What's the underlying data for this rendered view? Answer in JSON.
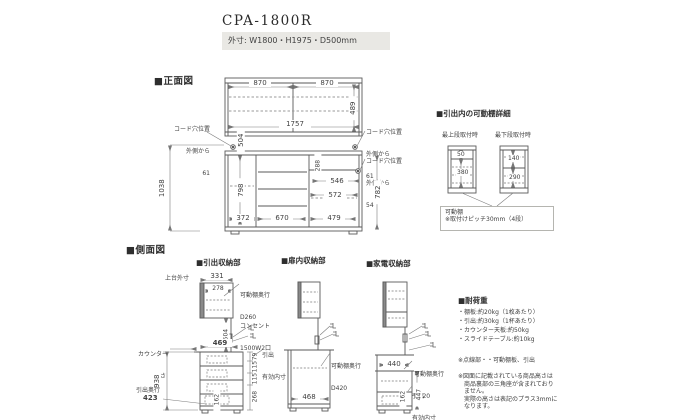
{
  "header": {
    "model": "CPA-1800R",
    "outer_dims": "外寸: W1800・H1975・D500mm"
  },
  "colors": {
    "subtitle_box_bg": "#e9e8e4",
    "line": "#5a5a5a",
    "dashed": "#9a9a9a"
  },
  "front": {
    "label": "■正面図",
    "d870a": "870",
    "d870b": "870",
    "d489": "489",
    "d1757": "1757",
    "d504": "504",
    "cord_left": {
      "l1": "コード穴位置",
      "l2": "外側から",
      "v": "61"
    },
    "cord_rt": {
      "l1": "コード穴位置",
      "l2": "外側から",
      "v": "61"
    },
    "cord_rb": {
      "l1": "コード穴位置",
      "l2": "外側から",
      "v": "54"
    },
    "d1038": "1038",
    "d798": "798",
    "d288": "288",
    "d546": "546",
    "d572": "572",
    "d782": "782",
    "d372": "372",
    "d670": "670",
    "d479": "479"
  },
  "detail": {
    "title": "■引出内の可動棚詳細",
    "cap_top": "最上段取付時",
    "cap_bottom": "最下段取付時",
    "v50": "50",
    "v380": "380",
    "v140": "140",
    "v290": "290",
    "note1": "可動棚",
    "note2": "※取付けピッチ30mm（4段）"
  },
  "side": {
    "label": "■側面図",
    "du": {
      "title": "■引出収納部",
      "upper_label": "上台外寸",
      "d331": "331",
      "d278": "278",
      "shelf1": "可動棚奥行",
      "shelf2": "D260",
      "d504": "504",
      "outlet1": "コンセント",
      "outlet2": "1500W2口",
      "counter1": "カウンター",
      "counter2": "高さ",
      "d469": "469",
      "d938": "938",
      "depth_label": "引出奥行",
      "d423": "423",
      "inner1": "引出",
      "inner2": "有効内寸",
      "d79": "79",
      "d115a": "115",
      "d115b": "115",
      "d268": "268",
      "d162": "162"
    },
    "door": {
      "title": "■扉内収納部",
      "shelf1": "可動棚奥行",
      "shelf2": "D420",
      "d468": "468"
    },
    "ap": {
      "title": "■家電収納部",
      "d440": "440",
      "shelf1": "可動棚奥行",
      "shelf2": "D420",
      "inner1": "引出",
      "inner2": "有効内寸",
      "d447": "447",
      "d162": "162"
    }
  },
  "load": {
    "title": "■耐荷重",
    "items": [
      "・棚板:約20kg（1枚あたり）",
      "・引出:約30kg（1杯あたり）",
      "・カウンター天板:約50kg",
      "・スライドテーブル:約10kg"
    ],
    "note_dotted": "※点線部・・可動棚板、引出",
    "nh": [
      "※図面に記載されている商品高さは",
      "　商品裏部の三角座が含まれており",
      "　ません。",
      "　実際の高さは表記のプラス3mmに",
      "　なります。"
    ]
  }
}
